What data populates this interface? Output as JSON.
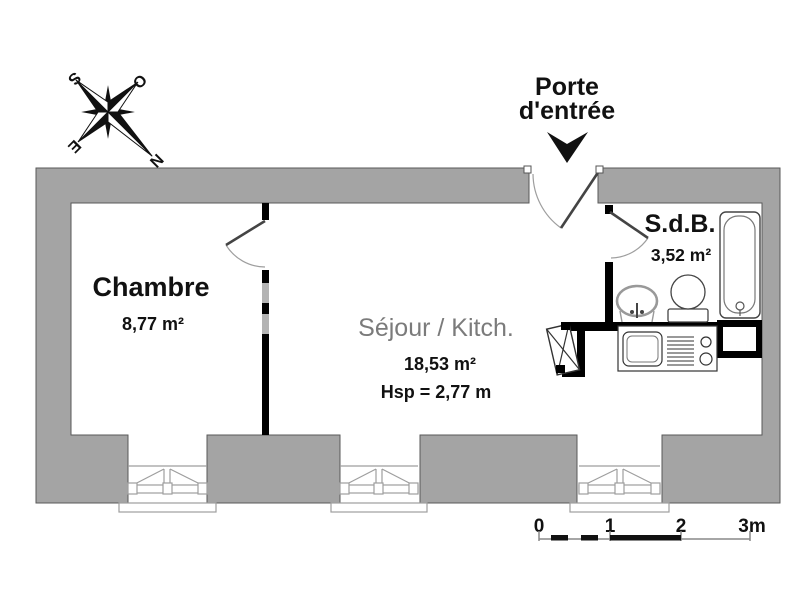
{
  "plan": {
    "entrance": {
      "line1": "Porte",
      "line2": "d'entrée"
    },
    "rooms": {
      "chambre": {
        "name": "Chambre",
        "area": "8,77 m²"
      },
      "sejour": {
        "name": "Séjour / Kitch.",
        "area": "18,53 m²",
        "ceiling_height": "Hsp = 2,77 m"
      },
      "sdb": {
        "name": "S.d.B.",
        "area": "3,52 m²"
      }
    },
    "compass": {
      "n": "N",
      "s": "S",
      "e": "E",
      "o": "O"
    },
    "scale_bar": {
      "t0": "0",
      "t1": "1",
      "t2": "2",
      "t3": "3m"
    }
  },
  "colors": {
    "wall_gray": "#a4a4a4",
    "wall_outline": "#595959",
    "interior_wall_black": "#000000",
    "fixture_line": "#444444",
    "window_line": "#9e9e9e",
    "text": "#111111",
    "sejour_text": "#7b7b7b"
  }
}
